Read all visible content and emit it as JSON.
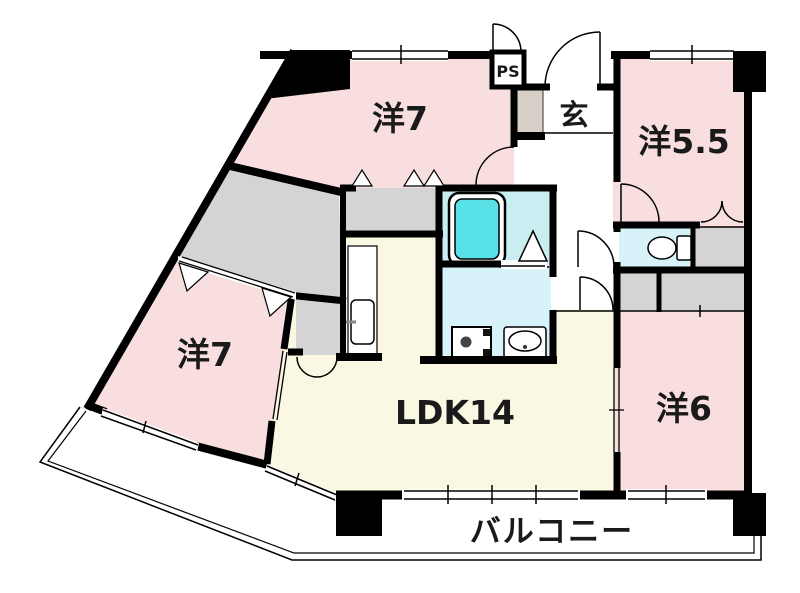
{
  "plan": {
    "rooms": {
      "west7_top": {
        "label": "洋7"
      },
      "west55": {
        "label": "洋5.5"
      },
      "west7_left": {
        "label": "洋7"
      },
      "ldk": {
        "label": "LDK14"
      },
      "west6": {
        "label": "洋6"
      },
      "entrance": {
        "label": "玄"
      },
      "pipe_space": {
        "label": "PS"
      },
      "balcony": {
        "label": "バルコニー"
      }
    },
    "colors": {
      "room_pink": "#F8DEDE",
      "ldk_cream": "#FAF7E2",
      "closet_gray": "#D5D4D4",
      "bath_cyan": "#C9EEF2",
      "wet_cyan": "#D7F2F8",
      "tub_cyan": "#58E2E8",
      "cabinet_beige": "#D8D0C6",
      "wall_black": "#000000",
      "white": "#FFFFFF"
    }
  }
}
